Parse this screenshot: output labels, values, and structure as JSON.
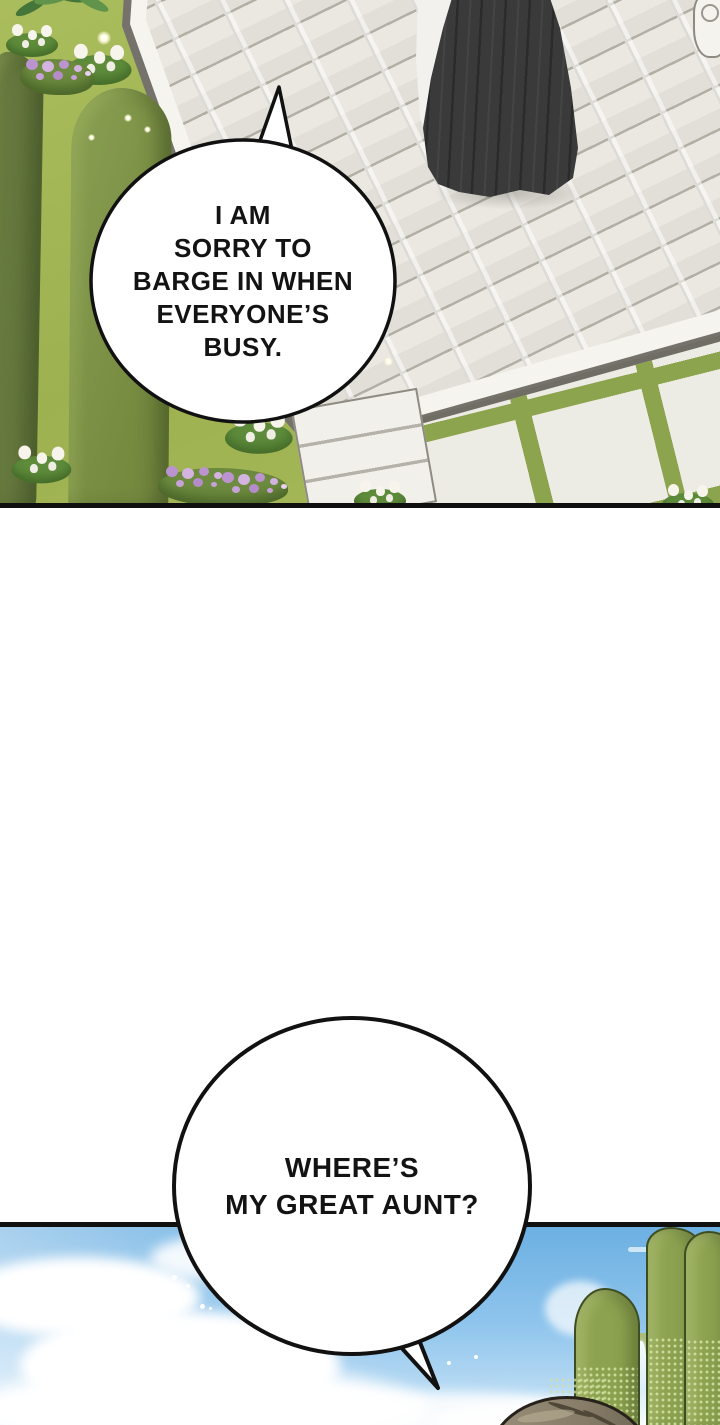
{
  "comic": {
    "bubbles": [
      {
        "id": "bubble-1",
        "lines": [
          "I AM",
          "SORRY TO",
          "BARGE IN WHEN",
          "EVERYONE’S",
          "BUSY."
        ]
      },
      {
        "id": "bubble-2",
        "lines": [
          "WHERE’S",
          "MY GREAT AUNT?"
        ]
      }
    ]
  },
  "colors": {
    "panel_border": "#101010",
    "bubble_fill": "#ffffff",
    "bubble_stroke": "#111111",
    "text_ink": "#131313",
    "grass": "#a3b757",
    "hedge_dark": "#66793e",
    "hedge_light": "#82964c",
    "pavement": "#ebe8e2",
    "pavement_mortar": "#b2afa4",
    "curb_white": "#f5f4ef",
    "paver_grass": "#8ca44d",
    "paver_white": "#ecebe4",
    "dress_black": "#3a3a3a",
    "apron_white": "#f2f1ed",
    "sky_top": "#6cb0e2",
    "sky_bottom": "#cde6f7",
    "cloud": "#ffffff",
    "cypress": "#8da250",
    "cypress_edge": "#42512a",
    "halftone": "#d5e4a5",
    "hair_brown": "#8a8069"
  }
}
